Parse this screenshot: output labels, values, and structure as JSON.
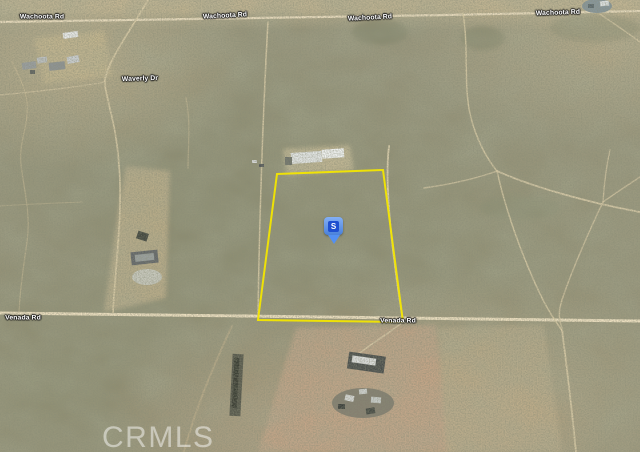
{
  "colors": {
    "boundary": "#f3e600",
    "marker_fill": "#5390f2",
    "marker_inner": "#1e4fd0",
    "marker_letter": "#ffffff",
    "label_text": "#ffffff",
    "watermark": "#ffffff"
  },
  "map": {
    "type": "satellite-aerial-imagery",
    "road_labels": [
      {
        "id": "wachoota-1",
        "text": "Wachoota Rd"
      },
      {
        "id": "wachoota-2",
        "text": "Wachoota Rd"
      },
      {
        "id": "wachoota-3",
        "text": "Wachoota Rd"
      },
      {
        "id": "wachoota-4",
        "text": "Wachoota Rd"
      },
      {
        "id": "waverly",
        "text": "Waverly Dr"
      },
      {
        "id": "venada-west",
        "text": "Venada Rd"
      },
      {
        "id": "venada-east",
        "text": "Venada Rd"
      }
    ],
    "marker": {
      "label": "S"
    },
    "watermark": "CRMLS"
  }
}
